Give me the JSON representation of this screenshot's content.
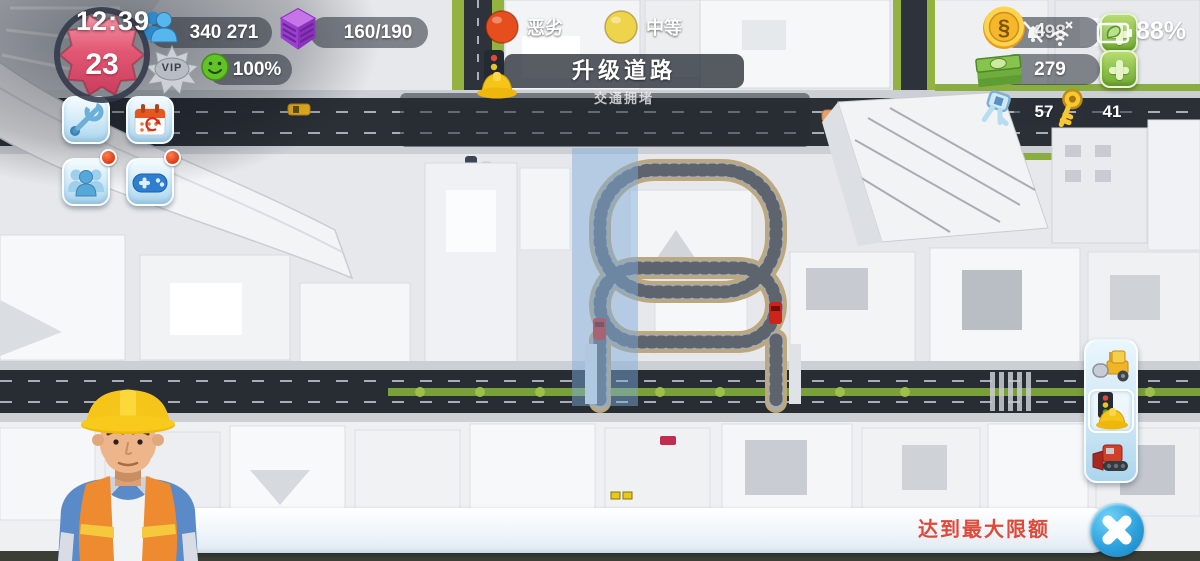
{
  "status_overlay": {
    "time": "12:39",
    "network": "4",
    "battery": "88%",
    "icons": [
      "bell-muted-icon",
      "wifi-x-icon",
      "battery-saver-icon"
    ]
  },
  "hud": {
    "level": {
      "value": "23",
      "vip": "VIP"
    },
    "population": {
      "value": "340 271"
    },
    "storage": {
      "value": "160/190"
    },
    "happiness": {
      "value": "100%"
    },
    "simoleons": {
      "value": "898",
      "symbol": "§"
    },
    "simcash": {
      "value": "279"
    },
    "platinum_keys": {
      "value": "57"
    },
    "golden_keys": {
      "value": "41"
    }
  },
  "left_toolbar": {
    "buttons": [
      {
        "name": "tools"
      },
      {
        "name": "daily-events"
      },
      {
        "name": "social",
        "notification": true
      },
      {
        "name": "minigames",
        "notification": true
      }
    ]
  },
  "road_panel": {
    "title": "升级道路",
    "subtitle": "交通拥堵",
    "legend": [
      {
        "label": "恶劣",
        "color": "#e64e1e"
      },
      {
        "label": "中等",
        "color": "#eed44a"
      }
    ]
  },
  "build_toolbar": {
    "items": [
      {
        "name": "build-road"
      },
      {
        "name": "upgrade-road",
        "selected": true
      },
      {
        "name": "demolish-road"
      }
    ]
  },
  "toast": {
    "message": "达到最大限额"
  },
  "colors": {
    "accent_blue": "#2da2dd",
    "legend_bad": "#e64e1e",
    "legend_medium": "#eed44a",
    "toast_text": "#e04838",
    "level_badge": "#e25874",
    "coin_gold": "#f0b42a",
    "cash_green": "#7cb943",
    "highlight_overlay": "rgba(126,172,218,0.48)"
  }
}
